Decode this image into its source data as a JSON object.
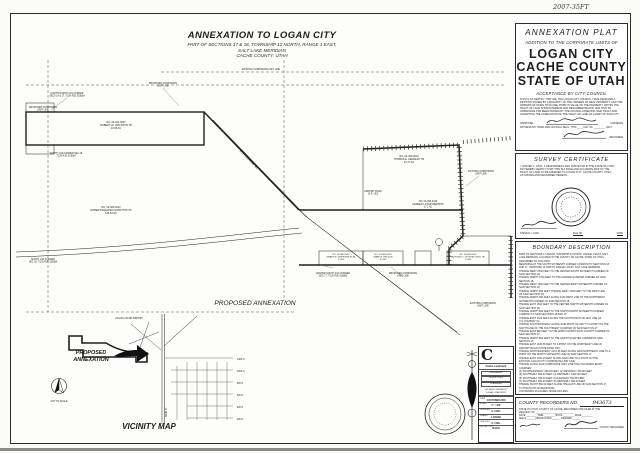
{
  "annotations": {
    "top_right": "2007-35FT"
  },
  "map_title": {
    "line1": "ANNEXATION TO LOGAN CITY",
    "line2": "PART OF SECTIONS 17 & 18, TOWNSHIP 12 NORTH, RANGE 1 EAST,",
    "line3": "SALT LAKE MERIDIAN",
    "line4": "CACHE COUNTY, UTAH"
  },
  "map": {
    "labels": [
      {
        "x": 105,
        "y": 109,
        "lines": [
          "NO. 04-041-0007",
          "ROBERT W. GRIFFITHS TR",
          "24.66 AC"
        ]
      },
      {
        "x": 100,
        "y": 194,
        "lines": [
          "NO. 04-060-0012",
          "ROBERT BRACKEN GRIFFITHS TR",
          "128.63 AC"
        ]
      },
      {
        "x": 398,
        "y": 143,
        "lines": [
          "NO. 04-060-0013",
          "THOMAS E. KENNEDY TR",
          "34.77 AC"
        ]
      },
      {
        "x": 417,
        "y": 188,
        "fs": 2.4,
        "lines": [
          "NO. 04-060-0010",
          "KENNEDY II PARTNERSHIP",
          "17.1 AC"
        ]
      },
      {
        "x": 330,
        "y": 241,
        "fs": 2.2,
        "lines": [
          "NO. 04-060-0019",
          "GRANT M. GRIFFITHS ET AL",
          "7.5 AC"
        ]
      },
      {
        "x": 372,
        "y": 241,
        "fs": 2.2,
        "lines": [
          "NO. 04-060-0020",
          "MARK R. NELSON",
          "5.2 AC"
        ]
      },
      {
        "x": 457,
        "y": 241,
        "fs": 2.2,
        "lines": [
          "NO. 04-060-0024",
          "ALFONSO C. MONTELONGO JR",
          "2.1 AC"
        ]
      },
      {
        "x": 152,
        "y": 70,
        "fs": 2.3,
        "lines": [
          "PROPOSED CORPORATE",
          "LIMIT LINE"
        ]
      },
      {
        "x": 56,
        "y": 80,
        "fs": 2.3,
        "lines": [
          "NORTH-NORTH 1/16 CORNER",
          "SECS 18 & 17, T12N R1E SLB&M"
        ]
      },
      {
        "x": 32,
        "y": 94,
        "fs": 2.3,
        "lines": [
          "PROPOSED CORPORATE",
          "LIMIT LINE"
        ]
      },
      {
        "x": 55,
        "y": 140,
        "fs": 2.3,
        "lines": [
          "NORTH 1/16 CORNER SEC 18",
          "T12N R1E SLB&M"
        ]
      },
      {
        "x": 250,
        "y": 56,
        "fs": 2.3,
        "lines": [
          "EXISTING CORPORATE LIMIT LINE"
        ]
      },
      {
        "x": 470,
        "y": 158,
        "fs": 2.3,
        "lines": [
          "EXISTING CORPORATE",
          "LIMIT LINE"
        ]
      },
      {
        "x": 362,
        "y": 178,
        "fs": 2.3,
        "lines": [
          "AIRPORT ROAD",
          "(S.R. 252)"
        ]
      },
      {
        "x": 322,
        "y": 260,
        "fs": 2.3,
        "lines": [
          "CENTER-SOUTH 1/16 CORNER",
          "SEC 17, T12N R1E SLB&M"
        ]
      },
      {
        "x": 392,
        "y": 260,
        "fs": 2.3,
        "lines": [
          "PROPOSED CORPORATE",
          "LIMIT LINE"
        ]
      },
      {
        "x": 472,
        "y": 290,
        "fs": 2.3,
        "lines": [
          "EXISTING CORPORATE",
          "LIMIT LINE"
        ]
      },
      {
        "x": 32,
        "y": 246,
        "fs": 2.3,
        "lines": [
          "SOUTH 1/16 CORNER",
          "SEC 18, T12N R1E SLB&M"
        ]
      },
      {
        "x": 244,
        "y": 291,
        "fs": 6.6,
        "it": 1,
        "lines": [
          "PROPOSED ANNEXATION"
        ]
      },
      {
        "x": 237,
        "y": 146,
        "rot": 46,
        "fs": 3,
        "it": 1,
        "lines": [
          "U.S. HIGHWAY 91"
        ]
      },
      {
        "x": 118,
        "y": 305,
        "fs": 2.3,
        "lines": [
          "LOGAN-CACHE AIRPORT"
        ]
      },
      {
        "x": 226,
        "y": 346,
        "fs": 2.3,
        "anchor": "start",
        "lines": [
          "1400 N"
        ]
      },
      {
        "x": 226,
        "y": 358,
        "fs": 2.3,
        "anchor": "start",
        "lines": [
          "1000 N"
        ]
      },
      {
        "x": 226,
        "y": 370,
        "fs": 2.3,
        "anchor": "start",
        "lines": [
          "800 N"
        ]
      },
      {
        "x": 226,
        "y": 382,
        "fs": 2.3,
        "anchor": "start",
        "lines": [
          "600 N"
        ]
      },
      {
        "x": 226,
        "y": 394,
        "fs": 2.3,
        "anchor": "start",
        "lines": [
          "400 N"
        ]
      },
      {
        "x": 226,
        "y": 406,
        "fs": 2.3,
        "anchor": "start",
        "lines": [
          "200 N"
        ]
      },
      {
        "x": 156,
        "y": 398,
        "rot": -90,
        "fs": 2.3,
        "lines": [
          "MAIN ST"
        ]
      },
      {
        "x": 80,
        "y": 340,
        "fs": 5.4,
        "it": 1,
        "b": 1,
        "lines": [
          "PROPOSED"
        ]
      },
      {
        "x": 80,
        "y": 347,
        "fs": 5.4,
        "it": 1,
        "b": 1,
        "lines": [
          "ANNEXATION"
        ]
      },
      {
        "x": 48,
        "y": 388,
        "fs": 2.3,
        "lines": [
          "NOT TO SCALE"
        ]
      },
      {
        "x": 138,
        "y": 415,
        "fs": 8,
        "it": 1,
        "b": 1,
        "lines": [
          "VICINITY MAP"
        ]
      }
    ]
  },
  "firm": {
    "logo_letter": "C",
    "name": "Cache Landmark",
    "services": [
      "ENGINEERS",
      "SURVEYORS",
      "PLANNERS"
    ],
    "address": [
      "165 WEST CENTER ST.",
      "LOGAN, UTAH 84321"
    ],
    "rows": [
      {
        "label": "DATE",
        "value": "4 OCTOBER 2006"
      },
      {
        "label": "SCALE",
        "value": "1\" = 400'"
      },
      {
        "label": "DESIGNED",
        "value": "S. CARL"
      },
      {
        "label": "DRAWN",
        "value": "J. DANIEL"
      },
      {
        "label": "CHECKED",
        "value": "S. CARL"
      },
      {
        "label": "PROJECT NO.",
        "value": "061034"
      }
    ]
  },
  "acceptance": {
    "title": "ANNEXATION PLAT",
    "subtitle": "ADDITION TO THE CORPORATE LIMITS OF",
    "city": "LOGAN CITY",
    "county": "CACHE COUNTY",
    "state": "STATE OF UTAH",
    "heading": "ACCEPTANCE BY CITY COUNCIL",
    "body": [
      "THIS IS TO CERTIFY THAT WE, THE LOGAN CITY COUNCIL, HAVE RECEIVED A",
      "PETITION SIGNED BY A MAJORITY OF THE OWNERS OF REAL PROPERTY, AND THE",
      "OWNERS OF MORE THAN ONE-THIRD IN VALUE OF THE PROPERTY WITHIN THE",
      "TRACT OF LAND SHOWN HEREON AND DESCRIBED BELOW, AND THAT AN",
      "ORDINANCE HAS BEEN PASSED BY THE COUNCIL ANNEXING SAID TRACT AND",
      "ACCEPTING THE ANNEXATION OF THE TRACT OF LAND AS A PART OF SAID CITY."
    ],
    "approved_label": "APPROVED",
    "approved_role": "CHAIRMAN",
    "witness_line": "WITNESS MY HAND AND OFFICIAL SEAL, THIS ____ DAY OF ________, 2007.",
    "recorder_label": "RECORDER"
  },
  "survey": {
    "heading": "SURVEY CERTIFICATE",
    "body": [
      "I, STEVEN J. CARL, A REGISTERED LAND SURVEYOR IN THE STATE OF UTAH,",
      "DO HEREBY CERTIFY THAT THIS IS A TRUE AND ACCURATE MAP OF THE",
      "TRACT OF LAND TO BE ANNEXED TO LOGAN CITY, CACHE COUNTY, UTAH,",
      "AS SHOWN AND DESCRIBED HEREON."
    ],
    "name": "STEVEN J. CARL",
    "file_no_label": "FILE NO.",
    "date_label": "DATE"
  },
  "boundary": {
    "heading": "BOUNDARY DESCRIPTION",
    "lines": [
      "PART OF SECTIONS 17 AND 18, TOWNSHIP 12 NORTH, RANGE 1 EAST, SALT",
      "LAKE MERIDIAN, LOCATED IN THE COUNTY OF CACHE, STATE OF UTAH,",
      "DESCRIBED AS FOLLOWS:",
      "BEGINNING AT THE SOUTH SIXTEENTH CORNER COMMON TO SECTIONS 18",
      "AND 17, TOWNSHIP 12 NORTH, RANGE 1 EAST, SALT LAKE MERIDIAN;",
      "THENCE WEST 2640 FEET TO THE CENTER-SOUTH SIXTEENTH CORNER OF",
      "SAID SECTION 18;",
      "THENCE NORTH 1320 FEET TO THE CENTER QUARTER CORNER OF SAID",
      "SECTION 18;",
      "THENCE WEST 1320 FEET TO THE CENTER-WEST SIXTEENTH CORNER OF",
      "SAID SECTION 18;",
      "THENCE NORTH 660 FEET; THENCE WEST 1320 FEET TO THE WEST LINE",
      "OF SAID SECTION 18;",
      "THENCE NORTH 660 FEET ALONG SAID WEST LINE TO THE NORTHWEST",
      "SIXTEENTH CORNER OF SAID SECTION 18;",
      "THENCE EAST 2640 FEET TO THE CENTER-NORTH SIXTEENTH CORNER OF",
      "SAID SECTION 18;",
      "THENCE NORTH 660 FEET TO THE NORTH-NORTH SIXTEENTH CORNER",
      "COMMON TO SAID SECTIONS 18 AND 17;",
      "THENCE EAST 1320 FEET ALONG THE SOUTH RIGHT-OF-WAY LINE OF",
      "U.S. HIGHWAY 91;",
      "THENCE SOUTHEASTERLY ALONG SAID RIGHT-OF-WAY TO A POINT ON THE",
      "NORTH LINE OF THE SOUTHWEST QUARTER OF SAID SECTION 17;",
      "THENCE EAST 990 FEET TO THE NORTH-NORTH SIXTY-FOURTH CORNER OF",
      "SAID SECTION 17;",
      "THENCE NORTH 860 FEET TO THE NORTH QUARTER CORNER OF SAID",
      "SECTION 17;",
      "THENCE EAST 1130.56 FEET TO A POINT ON THE NORTHEAST LINE OF",
      "AIRPORT ROAD (STATE ROAD 252);",
      "THENCE SOUTHEASTERLY 2070.43 FEET ALONG SAID NORTHEAST LINE TO A",
      "POINT ON THE NORTH SIXTEENTH LINE OF SAID SECTION 17;",
      "THENCE EAST 1340.10 FEET ALONG SAID LINE TO A POINT ON THE",
      "EXISTING LOGAN CITY CORPORATE LIMIT LINE;",
      "THENCE ALONG SAID CORPORATE LIMIT LINE THE FOLLOWING EIGHT",
      "COURSES:",
      "(1) SOUTHEASTERLY 660.00 FEET; (2) WESTERLY 430.00 FEET;",
      "(3) SOUTHERLY 660.00 FEET; (4) WESTERLY 1320.00 FEET;",
      "(5) SOUTHERLY 330.00 FEET; (6) EASTERLY 990.00 FEET;",
      "(7) SOUTHERLY 330.00 FEET; (8) WESTERLY 660.00 FEET;",
      "THENCE SOUTH 860.00 FEET ALONG THE EAST LINE OF SAID SECTION 17",
      "TO THE POINT OF BEGINNING.",
      "CONTAINING 214 ACRES, MORE OR LESS."
    ]
  },
  "recorder": {
    "heading": "COUNTY RECORDERS NO.",
    "number": "943673",
    "lines": [
      "STATE OF UTAH, COUNTY OF CACHE, RECORDED AND FILED AT THE",
      "REQUEST OF ____________________________",
      "DATE ________  TIME ________  BOOK ________  PAGE ________",
      "FEE $ ______  ABSTRACTED ______  INDEXED ______"
    ],
    "recorder_label": "COUNTY RECORDER"
  }
}
